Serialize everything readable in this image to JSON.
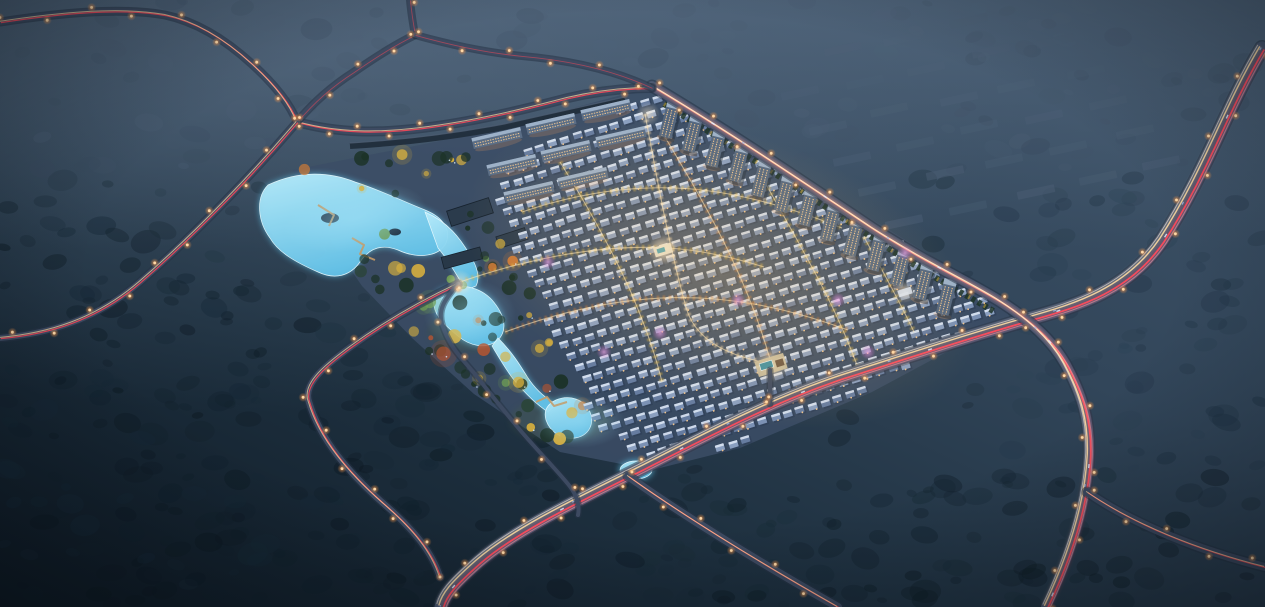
{
  "image": {
    "type": "architectural-aerial-rendering",
    "time_of_day": "night",
    "text_content": "none"
  },
  "scene": {
    "setting": "Dusk aerial view of a large residential development lit warmly, set in dark forested hills with illuminated roads",
    "regions": [
      {
        "name": "central-park",
        "features": [
          "glowing blue lakes and streams",
          "autumn trees in yellow and orange",
          "winding paths",
          "timber boardwalks",
          "dark amenity buildings"
        ]
      },
      {
        "name": "villa-district",
        "features": [
          "dense diagonal grid of low-rise houses with blue-grey roofs",
          "white lit ridges",
          "amber tree-lined streets",
          "magenta accent up-lights",
          "central lit clubhouse"
        ]
      },
      {
        "name": "apartment-rows",
        "features": [
          "mid-rise slab apartments along the north-east boundary with lit facades",
          "cluster of horizontal slabs at the north-west corner behind a boundary wall"
        ]
      },
      {
        "name": "south-clubhouse",
        "features": [
          "lit plaza with teal swimming pool beside the main road"
        ]
      },
      {
        "name": "context-buildings",
        "features": [
          "rows of unlit buildings fading into blue haze at upper right"
        ]
      },
      {
        "name": "road-network",
        "features": [
          "curving arterials with red and white headlight and taillight trails",
          "amber streetlights",
          "scattered cars",
          "major interchange at right"
        ]
      },
      {
        "name": "forest",
        "features": [
          "dense dark tree canopy across lower left and surrounding terrain",
          "hazy ridge lines toward the top"
        ]
      }
    ]
  },
  "palette": {
    "sky_haze": "#46596f",
    "terrain_base": "#2b3d50",
    "forest_dark": "#0e1b24",
    "site_base": "#3c4d66",
    "park_lawn": "#42583f",
    "water": "#8fd6f2",
    "water_glow": "#5fc3ea",
    "water_edge": "#e8faff",
    "tree_dark": "#1c3227",
    "tree_yellow": "#d9b13e",
    "tree_orange": "#cf7a36",
    "tree_light": "#6f9c55",
    "tree_red": "#b85530",
    "villa_roof": "#7b91b4",
    "villa_ridge": "#dfe9f6",
    "villa_shadow": "#2c3c55",
    "window_warm": "#ffcf92",
    "apartment_body": "#54677f",
    "apartment_roof": "#9db1c8",
    "ghost_building": "#4d6076",
    "road_base": "#46546e",
    "road_minor": "#3d4a61",
    "trail_red": "#ff4858",
    "trail_pink": "#ff93a3",
    "trail_warm": "#ffd9a0",
    "trail_white": "#fff0dd",
    "streetlight": "#ffa95c",
    "streetlight_core": "#ffd9a8",
    "bloom_warm": "#ffca7a",
    "bloom_magenta": "#e07bd8",
    "wall_dark": "#1f2c3a",
    "pool_teal": "#3e8fa0",
    "plaza_light": "#f7f2e2"
  }
}
